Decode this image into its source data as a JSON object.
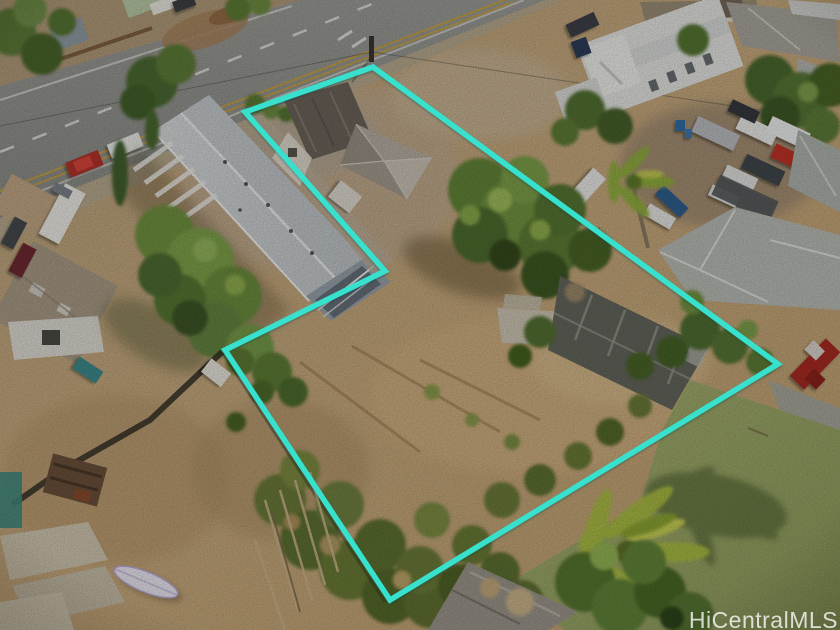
{
  "image": {
    "kind": "aerial-real-estate-listing-photo",
    "width": 840,
    "height": 630
  },
  "watermark": {
    "text": "HiCentralMLS"
  },
  "boundary": {
    "points": "245,112 373,67 778,364 390,600 225,350 385,271",
    "color": "#38E0CE",
    "stroke_width": 5.5
  },
  "palette": {
    "boundary_cyan": "#38E0CE",
    "road_asphalt": "#90908c",
    "bare_dirt": "#c2a378",
    "lawn_green": "#9aa767",
    "tree_canopy": "#5d7c34",
    "main_roof_gray": "#ccd0d2",
    "yellow_lane_line": "#c9a23c"
  }
}
